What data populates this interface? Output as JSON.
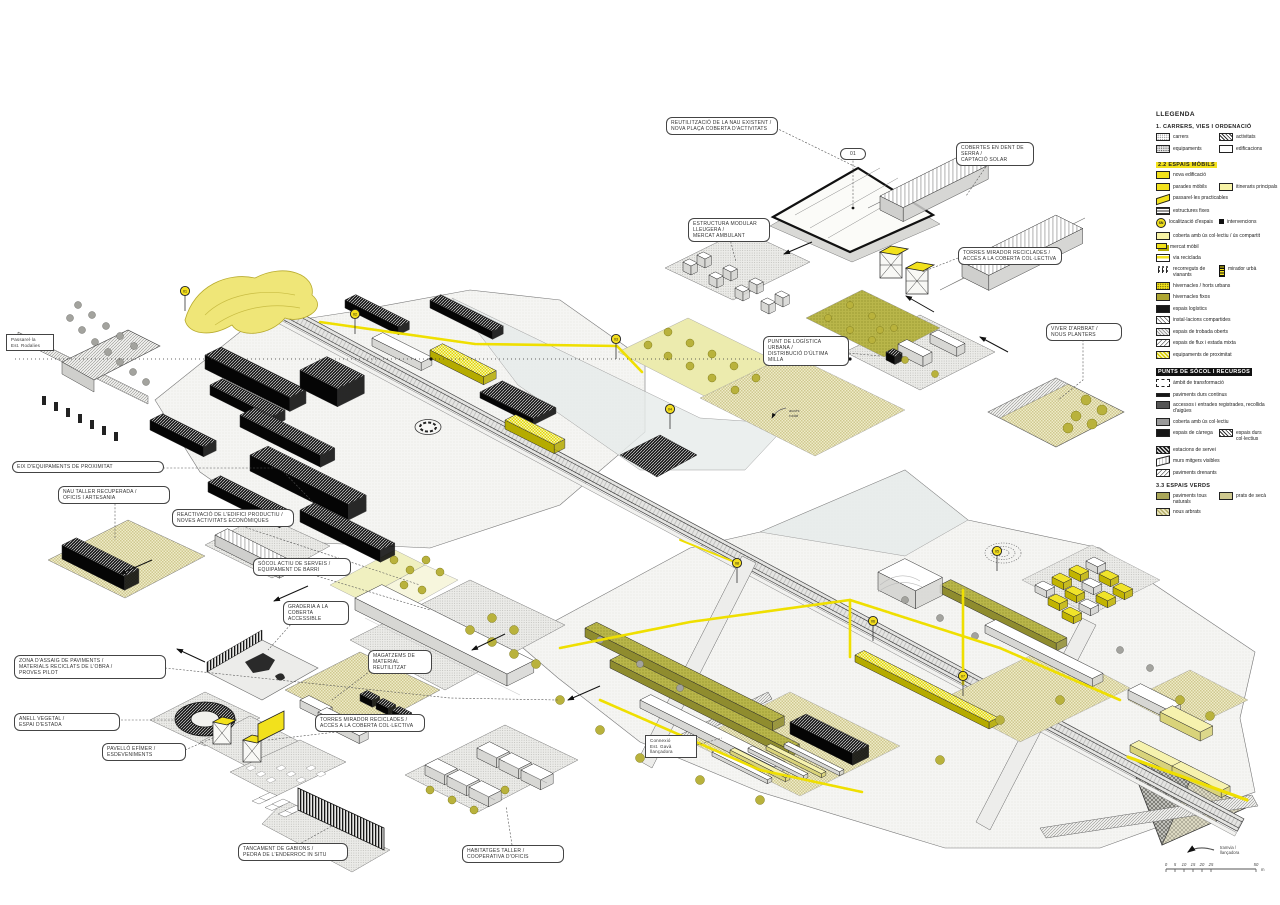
{
  "legend": {
    "title": "LLEGENDA",
    "sections": [
      {
        "id": "s1",
        "title": "1. CARRERS, VIES I ORDENACIÓ",
        "style": "plain",
        "rows": [
          [
            {
              "sw": "dotgrid",
              "label": "carrers"
            },
            {
              "sw": "checkerdark",
              "label": "activitats"
            }
          ],
          [
            {
              "sw": "densedot",
              "label": "equipaments"
            },
            {
              "sw": "white",
              "label": "edificacions"
            }
          ]
        ]
      },
      {
        "id": "s2",
        "title": "2.2 ESPAIS MÒBILS",
        "style": "yellow",
        "rows": [
          [
            {
              "sw": "yellowbold",
              "label": "nova edificació"
            }
          ],
          [
            {
              "sw": "yellow",
              "label": "parades mòbils"
            },
            {
              "sw": "yellowpale",
              "label": "itineraris principals"
            }
          ],
          [
            {
              "sw": "parayellow",
              "label": "passarel·les practicables"
            }
          ],
          [
            {
              "sw": "lines",
              "label": "estructures fixes"
            }
          ],
          [
            {
              "sw": "sn",
              "label": "localització d'espais",
              "swtext": "SN"
            },
            {
              "sw": "dot",
              "label": "intervencions"
            }
          ],
          [
            {
              "sw": "yellowpale2",
              "label": "coberta amb ús col·lectiu / ús compartit"
            }
          ],
          [
            {
              "sw": "minibox",
              "label": "mercat mòbil"
            }
          ],
          [
            {
              "sw": "yellowline",
              "label": "via reciclada"
            }
          ],
          [
            {
              "sw": "figures",
              "label": "recorreguts de vianants"
            },
            {
              "sw": "tower",
              "label": "mirador urbà"
            }
          ],
          [
            {
              "sw": "yellowdots",
              "label": "hivernacles / horts urbans"
            }
          ],
          [
            {
              "sw": "yellowdots2",
              "label": "hivernacles fixos"
            }
          ],
          [
            {
              "sw": "black",
              "label": "espais logístics"
            }
          ],
          [
            {
              "sw": "hatchdiag",
              "label": "instal·lacions compartides"
            }
          ],
          [
            {
              "sw": "hatchmix",
              "label": "espais de trobada oberts"
            }
          ],
          [
            {
              "sw": "hatchdiag2",
              "label": "espais de flux i estada mixta"
            }
          ],
          [
            {
              "sw": "yellowcheck",
              "label": "equipaments de proximitat"
            }
          ]
        ]
      },
      {
        "id": "s3",
        "title": "PUNTS DE SÒCOL I RECURSOS",
        "style": "black",
        "rows": [
          [
            {
              "sw": "dashed",
              "label": "àmbit de transformació"
            }
          ],
          [
            {
              "sw": "blackbar",
              "label": "paviments durs continus"
            }
          ],
          [
            {
              "sw": "graydark",
              "label": "accessos i entrades registrades, recollida d'aigües"
            }
          ],
          [
            {
              "sw": "graymid",
              "label": "coberta amb ús col·lectiu"
            }
          ],
          [
            {
              "sw": "black",
              "label": "espais de càrrega"
            },
            {
              "sw": "checkerdark",
              "label": "espais durs col·lectius"
            }
          ],
          [
            {
              "sw": "checkerdense",
              "label": "estacions de servei"
            }
          ],
          [
            {
              "sw": "stack",
              "label": "murs mitgers visibles"
            }
          ],
          [
            {
              "sw": "hatchdiag2",
              "label": "paviments drenants"
            }
          ]
        ]
      },
      {
        "id": "s4",
        "title": "3.3 ESPAIS VERDS",
        "style": "plain",
        "rows": [
          [
            {
              "sw": "olive",
              "label": "paviments tous naturals"
            },
            {
              "sw": "khakiicon",
              "label": "prats de secà"
            }
          ],
          [
            {
              "sw": "khakicheck",
              "label": "nous arbrats"
            }
          ]
        ]
      }
    ]
  },
  "callouts": [
    {
      "id": "c1",
      "lines": [
        "REUTILITZACIÓ DE LA NAU EXISTENT /",
        "NOVA PLAÇA COBERTA D'ACTIVITATS"
      ]
    },
    {
      "id": "c2",
      "lines": [
        "ESTRUCTURA MODULAR LLEUGERA /",
        "MERCAT AMBULANT"
      ]
    },
    {
      "id": "c3",
      "lines": [
        "COBERTES EN DENT DE SERRA /",
        "CAPTACIÓ SOLAR"
      ]
    },
    {
      "id": "c4",
      "lines": [
        "TORRES MIRADOR RECICLADES /",
        "ACCÉS A LA COBERTA COL·LECTIVA"
      ]
    },
    {
      "id": "c5",
      "lines": [
        "PUNT DE LOGÍSTICA URBANA /",
        "DISTRIBUCIÓ D'ÚLTIMA MILLA"
      ]
    },
    {
      "id": "c6",
      "lines": [
        "VIVER D'ARBRAT /",
        "NOUS PLANTERS"
      ]
    },
    {
      "id": "c7",
      "lines": [
        "EIX D'EQUIPAMENTS DE PROXIMITAT"
      ]
    },
    {
      "id": "c8",
      "lines": [
        "NAU TALLER RECUPERADA /",
        "OFICIS I ARTESANIA"
      ]
    },
    {
      "id": "c9",
      "lines": [
        "REACTIVACIÓ DE L'EDIFICI PRODUCTIU /",
        "NOVES ACTIVITATS ECONÒMIQUES"
      ]
    },
    {
      "id": "c10",
      "lines": [
        "SÒCOL ACTIU DE SERVEIS /",
        "EQUIPAMENT DE BARRI"
      ]
    },
    {
      "id": "c11",
      "lines": [
        "GRADERIA A LA",
        "COBERTA ACCESSIBLE"
      ]
    },
    {
      "id": "c12",
      "lines": [
        "MAGATZEMS DE",
        "MATERIAL REUTILITZAT"
      ]
    },
    {
      "id": "c13",
      "lines": [
        "ZONA D'ASSAIG DE PAVIMENTS /",
        "MATERIALS RECICLATS DE L'OBRA /",
        "PROVES PILOT"
      ]
    },
    {
      "id": "c14",
      "lines": [
        "ANELL VEGETAL /",
        "ESPAI D'ESTADA"
      ]
    },
    {
      "id": "c15",
      "lines": [
        "PAVELLÓ EFÍMER /",
        "ESDEVENIMENTS"
      ]
    },
    {
      "id": "c16",
      "lines": [
        "TORRES MIRADOR RECICLADES /",
        "ACCÉS A LA COBERTA COL·LECTIVA"
      ]
    },
    {
      "id": "c17",
      "lines": [
        "TANCAMENT DE GABIONS /",
        "PEDRA DE L'ENDERROC IN SITU"
      ]
    },
    {
      "id": "c18",
      "lines": [
        "HABITATGES TALLER /",
        "COOPERATIVA D'OFICIS"
      ]
    }
  ],
  "station_labels": [
    {
      "id": "st1",
      "lines": [
        "Passarel·la",
        "Est. Rodalies"
      ]
    },
    {
      "id": "st2",
      "lines": [
        "Connexió",
        "Est. Gavà",
        "llançadora"
      ]
    }
  ],
  "plaza_tag": "01",
  "pins": [
    "01",
    "02",
    "03",
    "04",
    "05",
    "06",
    "07",
    "08"
  ],
  "note_arrow": {
    "lines": [
      "accés",
      "rodat"
    ]
  },
  "shuttle": {
    "lines": [
      "tramvia /",
      "llançadora"
    ]
  },
  "scalebar": {
    "ticks": [
      "0",
      "5",
      "10",
      "15",
      "20",
      "25",
      "50"
    ],
    "unit": "m"
  }
}
